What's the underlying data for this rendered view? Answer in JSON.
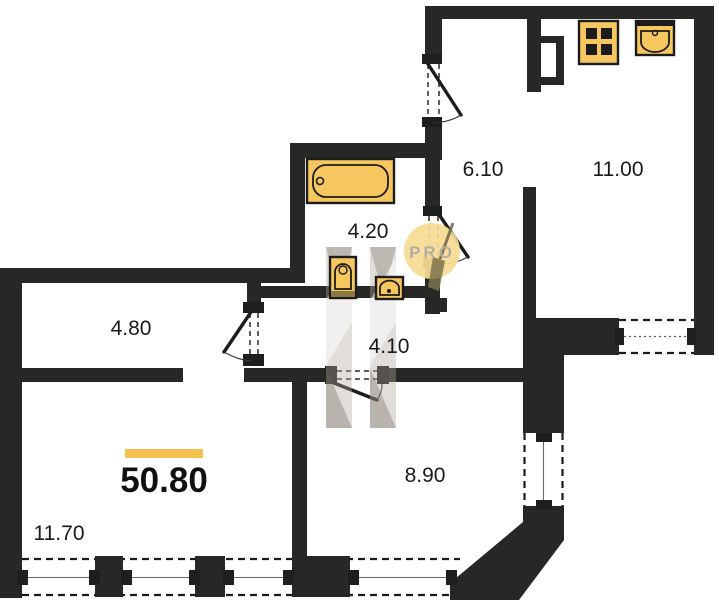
{
  "floorplan": {
    "total": {
      "value": "50.80"
    },
    "watermark": {
      "label": "PRO"
    },
    "rooms": [
      {
        "id": "entry-hall",
        "area": "6.10"
      },
      {
        "id": "kitchen-living",
        "area": "11.00"
      },
      {
        "id": "bathroom",
        "area": "4.20"
      },
      {
        "id": "corridor",
        "area": "4.10"
      },
      {
        "id": "inner-hall",
        "area": "4.80"
      },
      {
        "id": "bedroom",
        "area": "8.90"
      },
      {
        "id": "living-room",
        "area": "11.70"
      }
    ],
    "colors": {
      "accent": "#F2C14E",
      "wall": "#272725",
      "fixture": "#F6C75F",
      "watermark_circle": "#F7DB93"
    }
  }
}
